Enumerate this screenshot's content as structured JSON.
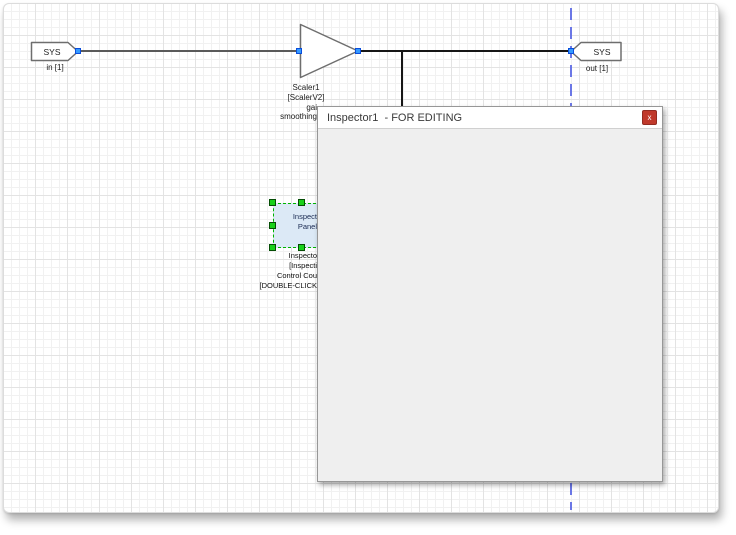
{
  "window": {
    "title": "Inspector1  - FOR EDITING",
    "close_label": "x"
  },
  "canvas": {
    "blocks": {
      "sys_in": {
        "label": "SYS",
        "sublabel": "in [1]"
      },
      "scaler": {
        "name": "Scaler1",
        "model": "[ScalerV2]",
        "param_line1": "gai",
        "param_line2": "smoothing"
      },
      "sys_out": {
        "label": "SYS",
        "sublabel": "out [1]"
      },
      "inspector_panel": {
        "line1": "Inspect",
        "line2": "Panel",
        "annotations": [
          "Inspecto",
          "[Inspecti",
          "Control Cou",
          "[DOUBLE-CLICK"
        ]
      }
    }
  },
  "colors": {
    "port_blue": "#3399ff",
    "guide_dashed_blue": "#6b77e6",
    "selection_green": "#19d119",
    "panel_fill_blue": "#dce9f6",
    "close_button_red": "#c0392b",
    "window_content_gray": "#efefef",
    "wire_black": "#161616"
  }
}
